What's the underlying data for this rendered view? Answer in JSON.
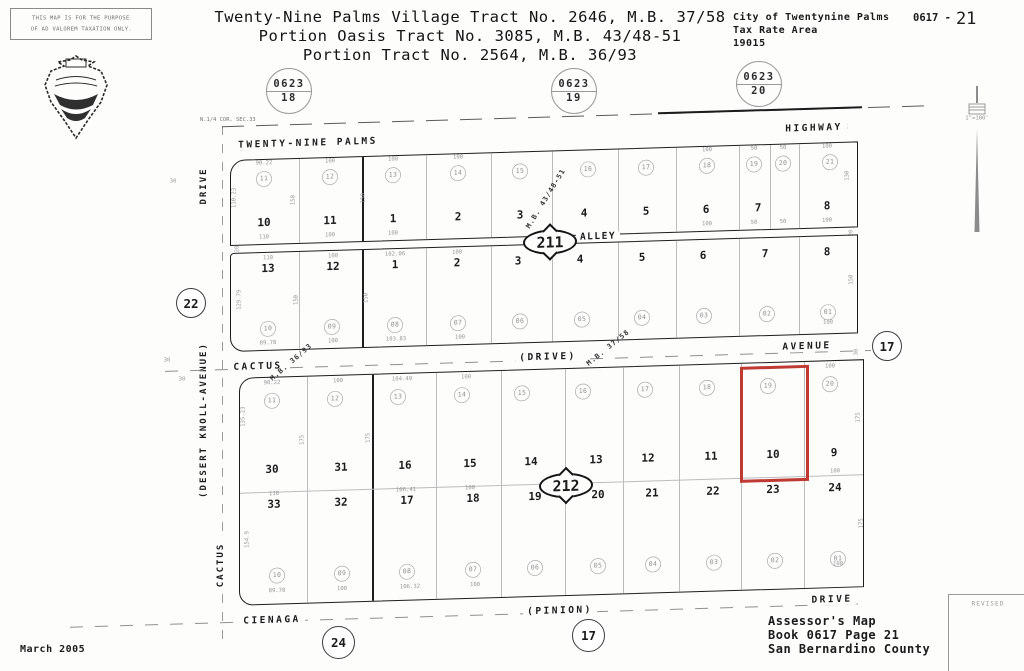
{
  "header": {
    "disclaimer_line1": "THIS MAP IS FOR THE PURPOSE",
    "disclaimer_line2": "OF AD VALOREM TAXATION ONLY.",
    "title_line1": "Twenty-Nine Palms Village Tract No. 2646, M.B. 37/58",
    "title_line2": "Portion Oasis Tract No. 3085, M.B. 43/48-51",
    "title_line3": "Portion Tract No. 2564, M.B. 36/93",
    "city": "City of Twentynine Palms",
    "tax_rate_area_label": "Tax Rate Area",
    "tax_rate_area_number": "19015",
    "sheet_prefix": "0617 -",
    "sheet_number": "21",
    "scale": "1\"=100'"
  },
  "sheet_circles": [
    {
      "book": "0623",
      "page": "18"
    },
    {
      "book": "0623",
      "page": "19"
    },
    {
      "book": "0623",
      "page": "20"
    }
  ],
  "ref_circles": {
    "west": "22",
    "east": "17",
    "south_left": "24",
    "south_center": "17"
  },
  "block_markers": {
    "north": "211",
    "south": "212"
  },
  "streets": {
    "top_left": "TWENTY-NINE PALMS",
    "top_right": "HIGHWAY",
    "alley": "ALLEY",
    "cactus": "CACTUS",
    "drive_paren": "(DRIVE)",
    "avenue": "AVENUE",
    "cienaga": "CIENAGA",
    "pinion": "(PINION)",
    "drive_bottom": "DRIVE",
    "west_drive": "DRIVE",
    "desert_knoll": "(DESERT KNOLL-AVENUE)",
    "cactus_west": "CACTUS"
  },
  "notes": {
    "corner": "N.1/4 COR. SEC.33",
    "mb_43": "M.B. 43/48-51",
    "mb_36": "M.B. 36/93",
    "mb_37": "M.B. 37/58"
  },
  "row1": {
    "parcels": [
      "11",
      "12",
      "13",
      "14",
      "15",
      "16",
      "17",
      "18",
      "19",
      "20",
      "21"
    ],
    "lots": [
      "10",
      "11",
      "1",
      "2",
      "3",
      "4",
      "5",
      "6",
      "7",
      "8"
    ]
  },
  "row2": {
    "lots": [
      "13",
      "12",
      "1",
      "2",
      "3",
      "4",
      "5",
      "6",
      "7",
      "8"
    ],
    "parcels": [
      "10",
      "09",
      "08",
      "07",
      "06",
      "05",
      "04",
      "03",
      "02",
      "01"
    ]
  },
  "row3": {
    "parcels_top": [
      "11",
      "12",
      "13",
      "14",
      "15",
      "16",
      "17",
      "18",
      "19",
      "20"
    ],
    "lots_upper": [
      "30",
      "31",
      "16",
      "15",
      "14",
      "13",
      "12",
      "11",
      "10",
      "9"
    ],
    "lots_lower": [
      "33",
      "32",
      "17",
      "18",
      "19",
      "20",
      "21",
      "22",
      "23",
      "24"
    ],
    "parcels_bottom": [
      "10",
      "09",
      "08",
      "07",
      "06",
      "05",
      "04",
      "03",
      "02",
      "01"
    ]
  },
  "dims": {
    "row1_top": [
      "90.22",
      "100",
      "100",
      "100",
      "100",
      "50",
      "50",
      "100"
    ],
    "row1_bottom": [
      "110",
      "100",
      "100",
      "100",
      "50",
      "50",
      "100"
    ],
    "row1_sides": [
      "110.23",
      "150",
      "150",
      "130"
    ],
    "row2_top": [
      "110",
      "100",
      "102.06",
      "100"
    ],
    "row2_bottom": [
      "89.78",
      "100",
      "103.83",
      "100",
      "100"
    ],
    "row2_sides": [
      "129.79",
      "150",
      "150",
      "150"
    ],
    "row3_top": [
      "90.22",
      "100",
      "104.49",
      "100",
      "100"
    ],
    "row3_mid": [
      "110",
      "106.41",
      "100",
      "100"
    ],
    "row3_bottom": [
      "89.78",
      "100",
      "106.32",
      "100",
      "100"
    ],
    "row3_sides": [
      "135.23",
      "154.9",
      "175",
      "175",
      "175",
      "175"
    ],
    "street_widths": [
      "30",
      "30",
      "30",
      "20",
      "50",
      "50",
      "20",
      "30"
    ]
  },
  "highlight": {
    "parcel": "19",
    "lot": "10",
    "color": "#bf3a32"
  },
  "footer": {
    "date": "March 2005",
    "line1": "Assessor's Map",
    "line2": "Book 0617 Page 21",
    "line3": "San Bernardino County",
    "revised": "REVISED"
  }
}
